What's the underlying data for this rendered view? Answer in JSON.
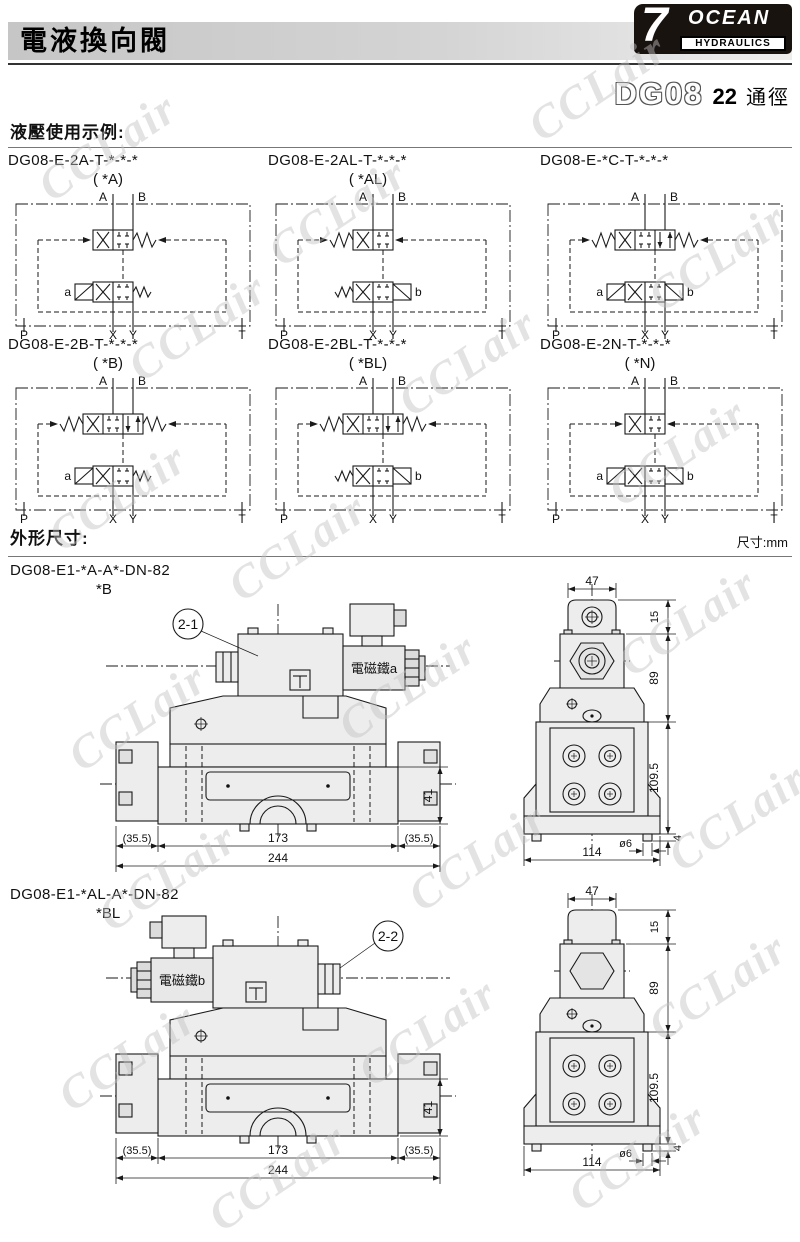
{
  "page": {
    "header_title": "電液換向閥",
    "logo": {
      "seven": "7",
      "ocean": "OCEAN",
      "hydraulics": "HYDRAULICS"
    },
    "model": {
      "series": "DG08",
      "size": "22",
      "size_unit": "通徑"
    },
    "usage_heading": "液壓使用示例:",
    "outline_heading": "外形尺寸:",
    "unit_note": "尺寸:mm",
    "watermark": "CCLair"
  },
  "schematics": [
    {
      "title": "DG08-E-2A-T-*-*-*",
      "subtitle": "( *A)",
      "ports_top": [
        "A",
        "B"
      ],
      "ports_bottom": [
        "P",
        "X",
        "Y",
        "T"
      ],
      "main": {
        "positions": 2,
        "springs": "right"
      },
      "pilot": {
        "left": "solenoid",
        "left_label": "a",
        "right": "spring",
        "right_label": ""
      }
    },
    {
      "title": "DG08-E-2AL-T-*-*-*",
      "subtitle": "( *AL)",
      "ports_top": [
        "A",
        "B"
      ],
      "ports_bottom": [
        "P",
        "X",
        "Y",
        "T"
      ],
      "main": {
        "positions": 2,
        "springs": "left"
      },
      "pilot": {
        "left": "spring",
        "left_label": "",
        "right": "solenoid",
        "right_label": "b"
      }
    },
    {
      "title": "DG08-E-*C-T-*-*-*",
      "subtitle": "",
      "ports_top": [
        "A",
        "B"
      ],
      "ports_bottom": [
        "P",
        "X",
        "Y",
        "T"
      ],
      "main": {
        "positions": 3,
        "springs": "both"
      },
      "pilot": {
        "left": "solenoid",
        "left_label": "a",
        "right": "solenoid",
        "right_label": "b"
      }
    },
    {
      "title": "DG08-E-2B-T-*-*-*",
      "subtitle": "( *B)",
      "ports_top": [
        "A",
        "B"
      ],
      "ports_bottom": [
        "P",
        "X",
        "Y",
        "T"
      ],
      "main": {
        "positions": 3,
        "springs": "both"
      },
      "pilot": {
        "left": "solenoid",
        "left_label": "a",
        "right": "spring",
        "right_label": ""
      }
    },
    {
      "title": "DG08-E-2BL-T-*-*-*",
      "subtitle": "( *BL)",
      "ports_top": [
        "A",
        "B"
      ],
      "ports_bottom": [
        "P",
        "X",
        "Y",
        "T"
      ],
      "main": {
        "positions": 3,
        "springs": "both"
      },
      "pilot": {
        "left": "spring",
        "left_label": "",
        "right": "solenoid",
        "right_label": "b"
      }
    },
    {
      "title": "DG08-E-2N-T-*-*-*",
      "subtitle": "( *N)",
      "ports_top": [
        "A",
        "B"
      ],
      "ports_bottom": [
        "P",
        "X",
        "Y",
        "T"
      ],
      "main": {
        "positions": 2,
        "springs": "none"
      },
      "pilot": {
        "left": "solenoid",
        "left_label": "a",
        "right": "solenoid",
        "right_label": "b"
      }
    }
  ],
  "drawings": [
    {
      "title": "DG08-E1-*A-A*-DN-82",
      "subtitle": "*B",
      "balloon": "2-1",
      "solenoid_label": "電磁鐵a",
      "solenoid_side": "right",
      "front_dims": {
        "left": "(35.5)",
        "center": "173",
        "right": "(35.5)",
        "overall": "244",
        "height": "41"
      },
      "side_dims": {
        "top": "47",
        "cap": "15",
        "upper": "89",
        "body": "109.5",
        "foot": "4",
        "base": "114",
        "hole": "ø6"
      }
    },
    {
      "title": "DG08-E1-*AL-A*-DN-82",
      "subtitle": "*BL",
      "balloon": "2-2",
      "solenoid_label": "電磁鐵b",
      "solenoid_side": "left",
      "front_dims": {
        "left": "(35.5)",
        "center": "173",
        "right": "(35.5)",
        "overall": "244",
        "height": "41"
      },
      "side_dims": {
        "top": "47",
        "cap": "15",
        "upper": "89",
        "body": "109.5",
        "foot": "4",
        "base": "114",
        "hole": "ø6"
      }
    }
  ]
}
